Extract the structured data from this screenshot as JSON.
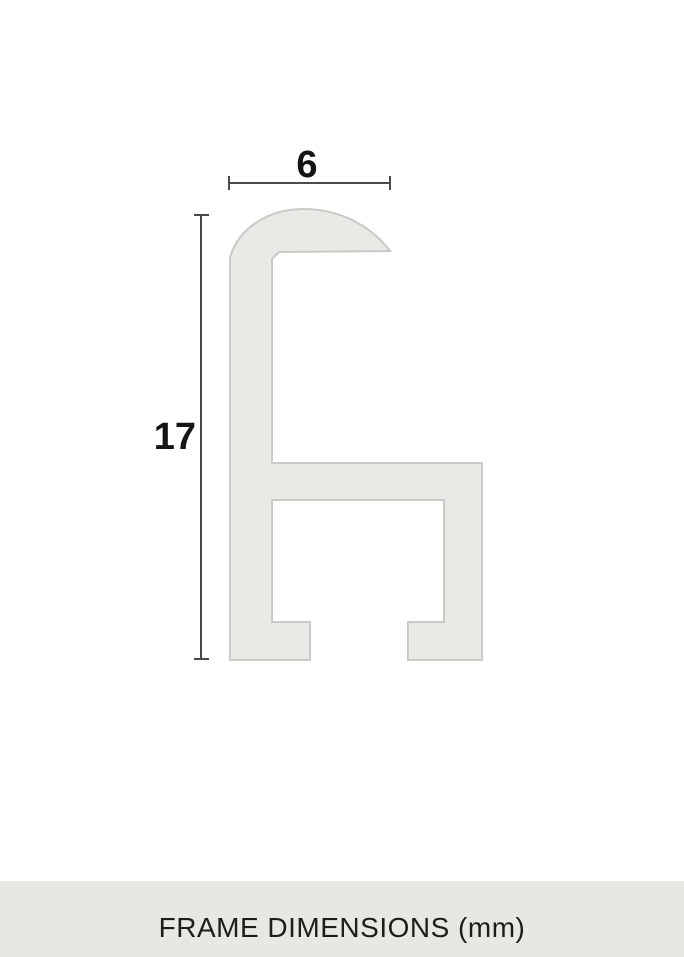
{
  "diagram": {
    "title": "frame profile cross-section",
    "width_label": "6",
    "height_label": "17",
    "dimensions": {
      "width_mm": "6",
      "height_mm": "17"
    },
    "profile_fill": "#e9e9e5",
    "profile_stroke": "#c9c9c6",
    "dimension_color": "#4b4b49",
    "label_color": "#151515"
  },
  "footer": {
    "text": "FRAME DIMENSIONS (mm)",
    "background": "#e8e8e3",
    "text_color": "#1d1d1d"
  }
}
